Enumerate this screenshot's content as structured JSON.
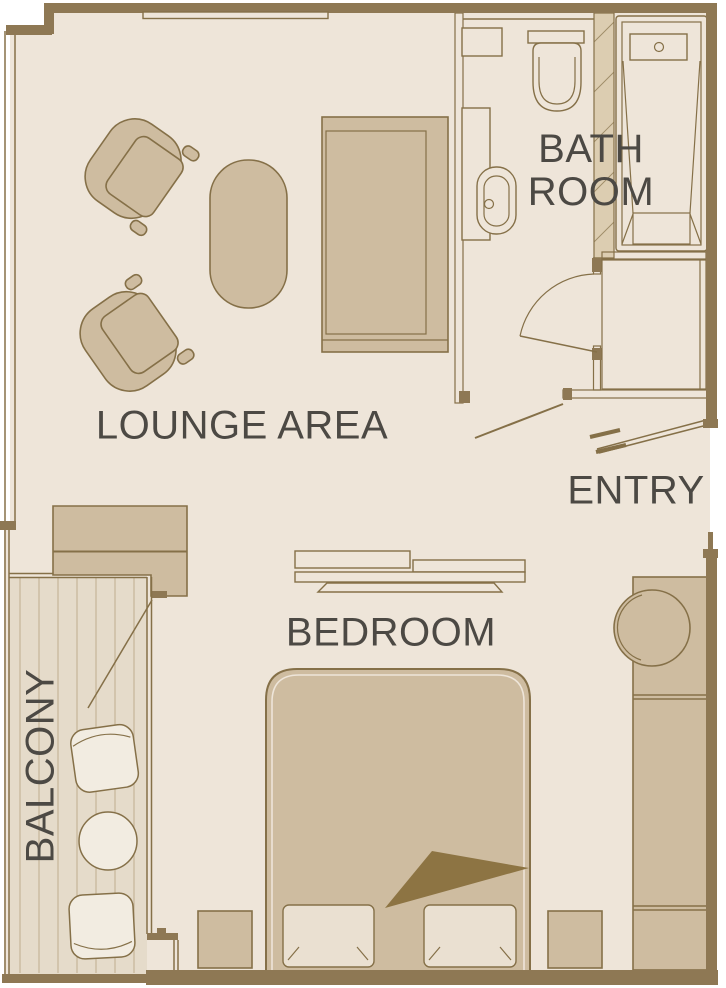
{
  "plan": {
    "type": "suite-floorplan",
    "rooms": [
      {
        "id": "lounge-area",
        "label": "LOUNGE AREA"
      },
      {
        "id": "bathroom",
        "label": "BATH ROOM",
        "lines": [
          "BATH",
          "ROOM"
        ]
      },
      {
        "id": "entry",
        "label": "ENTRY"
      },
      {
        "id": "bedroom",
        "label": "BEDROOM"
      },
      {
        "id": "balcony",
        "label": "BALCONY"
      }
    ],
    "furniture": [
      "armchair",
      "armchair",
      "coffee-table",
      "sofa",
      "desk-cabinet",
      "shelves",
      "double-bed",
      "pillow",
      "pillow",
      "blanket-fold",
      "nightstand",
      "nightstand",
      "wardrobe",
      "stool",
      "toilet",
      "washbasin",
      "vanity-counter",
      "bathroom-shelf",
      "bathtub",
      "entry-closet",
      "balcony-chair",
      "balcony-chair",
      "balcony-table",
      "balcony-deck",
      "bathroom-door",
      "corridor-door",
      "entry-door",
      "balcony-door"
    ],
    "colors": {
      "background": "#ffffff",
      "floor": "#eee5d9",
      "wall": "#8e7854",
      "wall_light": "#dccdb1",
      "furniture": "#cebca0",
      "outline": "#857048",
      "accent_dark": "#8d7443",
      "deck": "#e5dbca",
      "deck_stripe": "#c4b294",
      "light": "#f2ece1",
      "pillow": "#eae0d1",
      "label_text": "#4c4944"
    }
  }
}
